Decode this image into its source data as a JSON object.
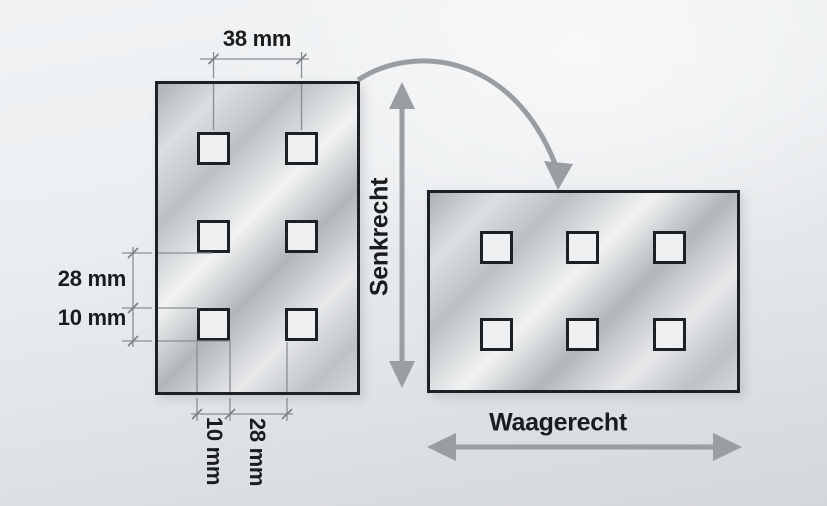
{
  "diagram": {
    "description": "Mounting-orientation diagram of two perforated plates with square holes",
    "dimensions": {
      "top_spacing": "38 mm",
      "left_gap": "28 mm",
      "left_hole": "10 mm",
      "bottom_hole": "10 mm",
      "bottom_gap": "28 mm"
    },
    "orientation_labels": {
      "vertical": "Senkrecht",
      "horizontal": "Waagerecht"
    },
    "plates": {
      "vertical": {
        "label": "vertical plate",
        "columns": 2,
        "rows": 3,
        "hole_positions": [
          [
            39,
            48
          ],
          [
            127,
            48
          ],
          [
            39,
            136
          ],
          [
            127,
            136
          ],
          [
            39,
            224
          ],
          [
            127,
            224
          ]
        ]
      },
      "horizontal": {
        "label": "horizontal plate",
        "columns": 3,
        "rows": 2,
        "hole_positions": [
          [
            50,
            38
          ],
          [
            136,
            38
          ],
          [
            223,
            38
          ],
          [
            50,
            125
          ],
          [
            136,
            125
          ],
          [
            223,
            125
          ]
        ]
      }
    },
    "colors": {
      "outline": "#1e2124",
      "dimension_line": "#8b8e91",
      "arrow": "#9b9ea1",
      "text": "#1a1c1e",
      "hole_fill": "#eef0f1"
    }
  }
}
